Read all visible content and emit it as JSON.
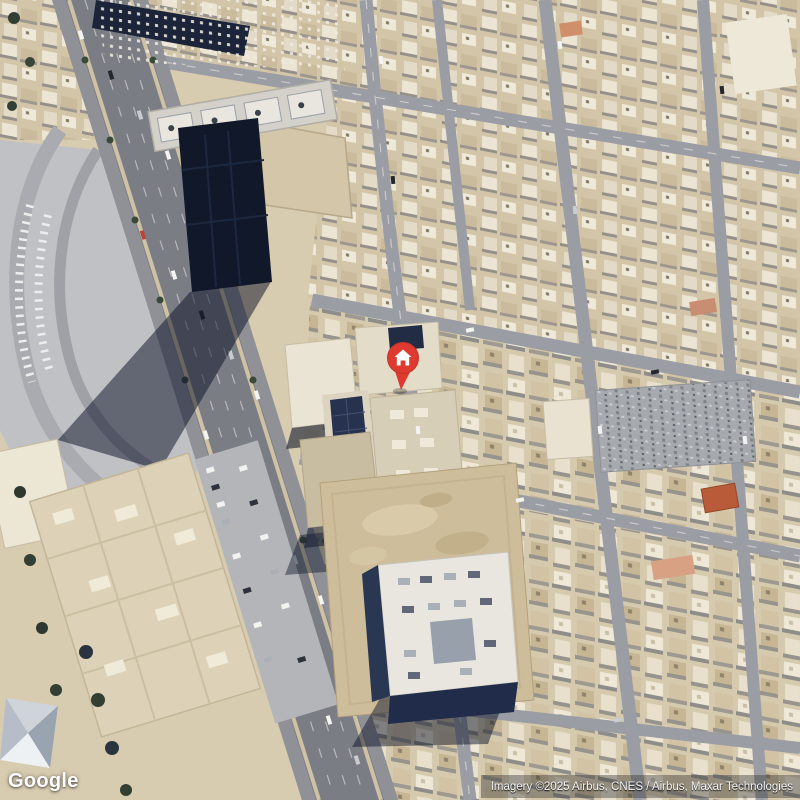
{
  "map": {
    "view_type": "satellite",
    "logo_text": "Google",
    "attribution_text": "Imagery ©2025 Airbus, CNES / Airbus, Maxar Technologies",
    "marker": {
      "name": "home-place-marker",
      "icon": "house-icon",
      "pin_color": "#de3a2f",
      "pin_rim_color": "#c2332a",
      "glyph_color": "#ffffff"
    },
    "palette": {
      "sand": "#d7cbb0",
      "road": "#9b9da4",
      "highway": "#7b7d84",
      "shadow": "#141c30",
      "rooftop_light": "#efe8d7",
      "dirt": "#cdbd9b",
      "tower_roof": "#10182a"
    }
  }
}
